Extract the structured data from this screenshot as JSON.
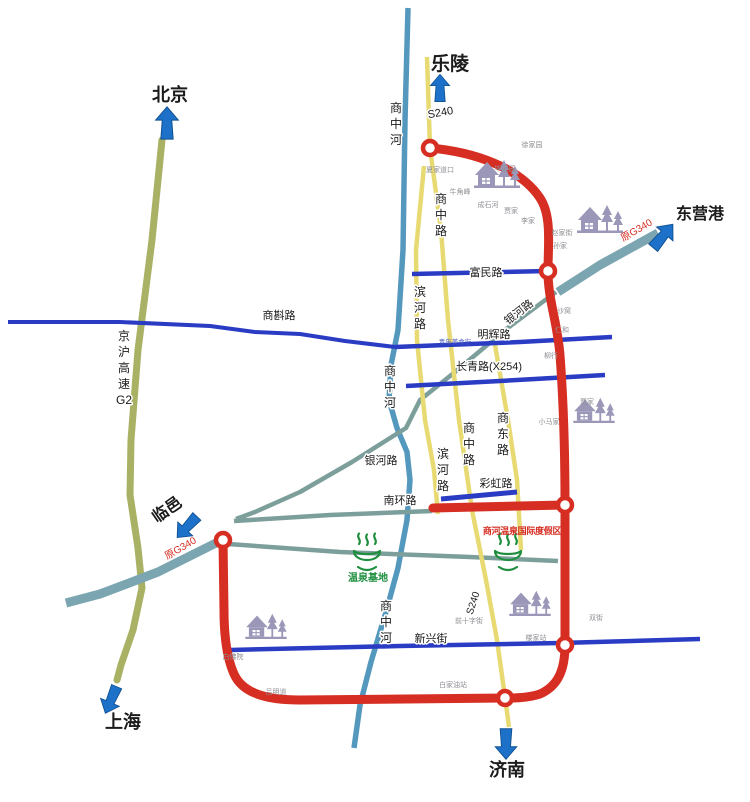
{
  "map": {
    "canvas": {
      "w": 750,
      "h": 802,
      "bg": "#ffffff"
    },
    "palette": {
      "black": "#1b1b1b",
      "gray": "#8f8f95",
      "red": "#d62e22",
      "green": "#1f8f3f",
      "white": "#ffffff",
      "blueSmall": "#4a5ac0",
      "arrow": "#1d71c8",
      "arrowEdge": "#10508f",
      "olive": "#a9b264",
      "river": "#5598bd",
      "corridor": "#7ba5b0",
      "teal": "#7d9f9b",
      "yellow": "#e8da72",
      "blue": "#2a3bc4",
      "icon": "#9a97b8"
    },
    "roads": [
      {
        "id": "jinghu-expressway-g2",
        "color": "olive",
        "w": 7,
        "cap": "round",
        "pts": [
          [
            162,
            140
          ],
          [
            152,
            240
          ],
          [
            138,
            350
          ],
          [
            131,
            440
          ],
          [
            130,
            495
          ],
          [
            138,
            548
          ],
          [
            142,
            588
          ],
          [
            133,
            630
          ],
          [
            121,
            665
          ],
          [
            117,
            680
          ]
        ]
      },
      {
        "id": "old-g340-beizhanhe-northeast",
        "color": "corridor",
        "w": 9,
        "pts": [
          [
            658,
            233
          ],
          [
            600,
            265
          ],
          [
            558,
            292
          ]
        ]
      },
      {
        "id": "old-g340-beizhanhe-southwest",
        "color": "corridor",
        "w": 9,
        "pts": [
          [
            226,
            538
          ],
          [
            158,
            572
          ],
          [
            100,
            594
          ],
          [
            66,
            603
          ]
        ]
      },
      {
        "id": "shangzhong-river",
        "color": "river",
        "w": 5.5,
        "pts": [
          [
            408,
            8
          ],
          [
            405,
            120
          ],
          [
            403,
            250
          ],
          [
            398,
            330
          ],
          [
            391,
            365
          ],
          [
            389,
            400
          ],
          [
            397,
            428
          ],
          [
            407,
            452
          ],
          [
            410,
            480
          ],
          [
            407,
            520
          ],
          [
            398,
            568
          ],
          [
            386,
            612
          ],
          [
            371,
            662
          ],
          [
            360,
            705
          ],
          [
            354,
            748
          ]
        ]
      },
      {
        "id": "yinhe-road",
        "color": "teal",
        "w": 4.5,
        "pts": [
          [
            556,
            292
          ],
          [
            505,
            330
          ],
          [
            455,
            372
          ],
          [
            420,
            400
          ],
          [
            406,
            428
          ],
          [
            352,
            462
          ],
          [
            300,
            492
          ],
          [
            255,
            512
          ],
          [
            236,
            519
          ]
        ]
      },
      {
        "id": "nanhuan-road",
        "color": "teal",
        "w": 4.5,
        "pts": [
          [
            234,
            521
          ],
          [
            330,
            515
          ],
          [
            432,
            511
          ]
        ]
      },
      {
        "id": "old-g340-town-section",
        "color": "teal",
        "w": 4.5,
        "pts": [
          [
            228,
            544
          ],
          [
            340,
            552
          ],
          [
            470,
            557
          ],
          [
            558,
            561
          ]
        ]
      },
      {
        "id": "s240-shangzhong-road",
        "color": "yellow",
        "w": 4.5,
        "pts": [
          [
            427,
            57
          ],
          [
            430,
            148
          ],
          [
            441,
            230
          ],
          [
            448,
            320
          ],
          [
            459,
            420
          ],
          [
            472,
            510
          ],
          [
            486,
            580
          ],
          [
            497,
            640
          ],
          [
            505,
            697
          ],
          [
            509,
            727
          ]
        ]
      },
      {
        "id": "binhe-road",
        "color": "yellow",
        "w": 4.5,
        "pts": [
          [
            424,
            166
          ],
          [
            416,
            250
          ],
          [
            417,
            340
          ],
          [
            425,
            420
          ],
          [
            434,
            470
          ],
          [
            438,
            514
          ]
        ]
      },
      {
        "id": "shangdong-road",
        "color": "yellow",
        "w": 4.5,
        "pts": [
          [
            495,
            345
          ],
          [
            508,
            420
          ],
          [
            517,
            480
          ],
          [
            521,
            550
          ]
        ]
      },
      {
        "id": "fumin-road",
        "color": "blue",
        "w": 4.5,
        "pts": [
          [
            412,
            274
          ],
          [
            548,
            271
          ]
        ]
      },
      {
        "id": "shangzhen-road",
        "color": "blue",
        "w": 4,
        "pts": [
          [
            8,
            322
          ],
          [
            120,
            322
          ],
          [
            210,
            326
          ],
          [
            255,
            332
          ],
          [
            300,
            334
          ],
          [
            345,
            341
          ],
          [
            395,
            347
          ]
        ]
      },
      {
        "id": "minghui-road",
        "color": "blue",
        "w": 4.5,
        "pts": [
          [
            395,
            347
          ],
          [
            520,
            342
          ],
          [
            612,
            337
          ]
        ]
      },
      {
        "id": "changqing-road-x254",
        "color": "blue",
        "w": 4.5,
        "pts": [
          [
            406,
            386
          ],
          [
            500,
            381
          ],
          [
            605,
            375
          ]
        ]
      },
      {
        "id": "caihong-road",
        "color": "blue",
        "w": 5,
        "pts": [
          [
            441,
            499
          ],
          [
            517,
            492
          ]
        ]
      },
      {
        "id": "xinxing-street",
        "color": "blue",
        "w": 4.5,
        "pts": [
          [
            230,
            650
          ],
          [
            400,
            646
          ],
          [
            560,
            643
          ],
          [
            700,
            639
          ]
        ]
      },
      {
        "id": "s240-ring-road",
        "color": "red",
        "w": 9,
        "path": "M 430,148 C 475,152 520,168 540,198 C 552,216 548,245 548,271 C 548,300 557,320 560,355 C 563,395 565,450 565,505 L 565,645 C 565,670 558,686 540,694 C 528,698 515,698 505,698 L 300,700 C 268,700 243,694 234,674 C 226,656 224,630 224,610 L 223,540"
      },
      {
        "id": "resort-access-road",
        "color": "red",
        "w": 9,
        "cap": "round",
        "pts": [
          [
            433,
            508
          ],
          [
            565,
            505
          ]
        ]
      }
    ],
    "junctions": {
      "r": 7,
      "points": [
        [
          430,
          148
        ],
        [
          548,
          271
        ],
        [
          223,
          540
        ],
        [
          565,
          505
        ],
        [
          565,
          645
        ],
        [
          505,
          698
        ]
      ]
    },
    "village_icons": [
      [
        497,
        188,
        1.0
      ],
      [
        600,
        233,
        1.0
      ],
      [
        594,
        423,
        0.9
      ],
      [
        530,
        616,
        0.9
      ],
      [
        266,
        639,
        0.9
      ]
    ],
    "spring_logos": [
      [
        367,
        562
      ],
      [
        508,
        562
      ]
    ],
    "arrows": [
      {
        "id": "beijing",
        "x": 167,
        "y": 123,
        "rot": 0,
        "sc": 0.95
      },
      {
        "id": "leling",
        "x": 440,
        "y": 88,
        "rot": 0,
        "sc": 0.8
      },
      {
        "id": "dongyinggang",
        "x": 663,
        "y": 236,
        "rot": 40,
        "sc": 0.9
      },
      {
        "id": "linyi",
        "x": 187,
        "y": 527,
        "rot": 223,
        "sc": 0.85
      },
      {
        "id": "shanghai",
        "x": 111,
        "y": 700,
        "rot": 203,
        "sc": 0.85
      },
      {
        "id": "jinan",
        "x": 506,
        "y": 744,
        "rot": 180,
        "sc": 0.9
      }
    ],
    "labels": [
      {
        "id": "dest-beijing",
        "t": "北京",
        "x": 170,
        "y": 101,
        "s": 18,
        "c": "black",
        "b": 1
      },
      {
        "id": "dest-leling",
        "t": "乐陵",
        "x": 450,
        "y": 70,
        "s": 19,
        "c": "black",
        "b": 1
      },
      {
        "id": "dest-dongyinggang",
        "t": "东营港",
        "x": 700,
        "y": 219,
        "s": 16,
        "c": "black",
        "b": 1
      },
      {
        "id": "dest-linyi",
        "t": "临邑",
        "x": 170,
        "y": 514,
        "s": 16,
        "c": "black",
        "b": 1,
        "rot": -35
      },
      {
        "id": "dest-shanghai",
        "t": "上海",
        "x": 123,
        "y": 728,
        "s": 18,
        "c": "black",
        "b": 1
      },
      {
        "id": "dest-jinan",
        "t": "济南",
        "x": 507,
        "y": 776,
        "s": 18,
        "c": "black",
        "b": 1
      },
      {
        "id": "label-s240-north",
        "t": "S240",
        "x": 441,
        "y": 116,
        "s": 11,
        "c": "black",
        "halo": 1,
        "rot": -10
      },
      {
        "id": "label-s240-south",
        "t": "S240",
        "x": 476,
        "y": 604,
        "s": 10,
        "c": "black",
        "halo": 1,
        "rot": -72
      },
      {
        "id": "label-shangzhonghe-north",
        "t": "商中河",
        "x": 396,
        "y": 112,
        "s": 12,
        "c": "black",
        "v": 1,
        "halo": 1
      },
      {
        "id": "label-shangzhonghe-middle",
        "t": "商中河",
        "x": 390,
        "y": 375,
        "s": 12,
        "c": "black",
        "v": 1,
        "halo": 1
      },
      {
        "id": "label-shangzhonghe-south",
        "t": "商中河",
        "x": 386,
        "y": 610,
        "s": 12,
        "c": "black",
        "v": 1,
        "halo": 1
      },
      {
        "id": "label-shangzhong-road-north",
        "t": "商中路",
        "x": 441,
        "y": 203,
        "s": 12,
        "c": "black",
        "v": 1,
        "halo": 1
      },
      {
        "id": "label-shangzhong-road-south",
        "t": "商中路",
        "x": 469,
        "y": 432,
        "s": 12,
        "c": "black",
        "v": 1,
        "halo": 1
      },
      {
        "id": "label-binhe-road-north",
        "t": "滨河路",
        "x": 420,
        "y": 296,
        "s": 12,
        "c": "black",
        "v": 1,
        "halo": 1
      },
      {
        "id": "label-binhe-road-south",
        "t": "滨河路",
        "x": 443,
        "y": 458,
        "s": 12,
        "c": "black",
        "v": 1,
        "halo": 1
      },
      {
        "id": "label-shangdong-road",
        "t": "商东路",
        "x": 503,
        "y": 422,
        "s": 12,
        "c": "black",
        "v": 1,
        "halo": 1
      },
      {
        "id": "label-jinghu-g2",
        "t": "京沪高速G2",
        "x": 124,
        "y": 340,
        "s": 12,
        "c": "black",
        "v": 1,
        "halo": 1
      },
      {
        "id": "label-fumin-road",
        "t": "富民路",
        "x": 486,
        "y": 276,
        "s": 11,
        "c": "black",
        "halo": 1
      },
      {
        "id": "label-shangzhen-road",
        "t": "商斟路",
        "x": 279,
        "y": 319,
        "s": 11,
        "c": "black",
        "halo": 1
      },
      {
        "id": "label-minghui-road",
        "t": "明辉路",
        "x": 494,
        "y": 338,
        "s": 11,
        "c": "black",
        "halo": 1
      },
      {
        "id": "label-changqing-road",
        "t": "长青路(X254)",
        "x": 489,
        "y": 370,
        "s": 11,
        "c": "black",
        "halo": 1
      },
      {
        "id": "label-caihong-road",
        "t": "彩虹路",
        "x": 496,
        "y": 487,
        "s": 11,
        "c": "black",
        "halo": 1
      },
      {
        "id": "label-nanhuan-road",
        "t": "南环路",
        "x": 400,
        "y": 504,
        "s": 11,
        "c": "black",
        "halo": 1
      },
      {
        "id": "label-xinxing-street",
        "t": "新兴街",
        "x": 431,
        "y": 642,
        "s": 11,
        "c": "black",
        "halo": 1
      },
      {
        "id": "label-yinhe-road-northeast",
        "t": "银河路",
        "x": 521,
        "y": 315,
        "s": 11,
        "c": "black",
        "halo": 1,
        "rot": -38
      },
      {
        "id": "label-yinhe-road-southwest",
        "t": "银河路",
        "x": 381,
        "y": 464,
        "s": 11,
        "c": "black",
        "halo": 1
      },
      {
        "id": "label-old-g340-northeast",
        "t": "原G340",
        "x": 638,
        "y": 233,
        "s": 10,
        "c": "red",
        "rot": -30
      },
      {
        "id": "label-old-g340-southwest",
        "t": "原G340",
        "x": 182,
        "y": 551,
        "s": 10,
        "c": "red",
        "rot": -30
      },
      {
        "id": "label-beizhanhe-northeast",
        "t": "备战河",
        "x": 610,
        "y": 277,
        "s": 9,
        "c": "white",
        "rot": -35
      },
      {
        "id": "label-beizhanhe-southwest",
        "t": "备战河",
        "x": 186,
        "y": 575,
        "s": 9,
        "c": "white",
        "rot": -30
      },
      {
        "id": "label-wenquan-jidi",
        "t": "温泉基地",
        "x": 368,
        "y": 581,
        "s": 10,
        "c": "green",
        "b": 1
      },
      {
        "id": "label-resort",
        "t": "商河温泉国际度假区",
        "x": 522,
        "y": 534,
        "s": 9,
        "c": "red",
        "b": 1,
        "sp": "-0.3"
      },
      {
        "id": "label-qingnian-food-street",
        "t": "青年美食街",
        "x": 455,
        "y": 344,
        "s": 6.5,
        "c": "blueSmall"
      },
      {
        "id": "village-xujiayuan",
        "t": "徐家园",
        "x": 532,
        "y": 147,
        "s": 7,
        "c": "gray"
      },
      {
        "id": "village-xiajiadaokou",
        "t": "夏家道口",
        "x": 440,
        "y": 172,
        "s": 7,
        "c": "gray"
      },
      {
        "id": "village-bijiayuan",
        "t": "毕家园",
        "x": 505,
        "y": 171,
        "s": 7,
        "c": "gray"
      },
      {
        "id": "village-niujiaofeng",
        "t": "牛角峰",
        "x": 460,
        "y": 194,
        "s": 7,
        "c": "gray"
      },
      {
        "id": "village-chengshihe",
        "t": "成石河",
        "x": 488,
        "y": 207,
        "s": 7,
        "c": "gray"
      },
      {
        "id": "village-jiajia-north",
        "t": "贾家",
        "x": 511,
        "y": 213,
        "s": 7,
        "c": "gray"
      },
      {
        "id": "village-lijia",
        "t": "李家",
        "x": 528,
        "y": 223,
        "s": 7,
        "c": "gray"
      },
      {
        "id": "village-zhaojiajie",
        "t": "赵家街",
        "x": 562,
        "y": 235,
        "s": 7,
        "c": "gray"
      },
      {
        "id": "village-sunjia",
        "t": "孙家",
        "x": 560,
        "y": 248,
        "s": 7,
        "c": "gray"
      },
      {
        "id": "village-shawo",
        "t": "沙窝",
        "x": 564,
        "y": 313,
        "s": 7,
        "c": "gray"
      },
      {
        "id": "village-renhe",
        "t": "仁和",
        "x": 562,
        "y": 332,
        "s": 7,
        "c": "gray"
      },
      {
        "id": "village-liuhang",
        "t": "柳行",
        "x": 551,
        "y": 358,
        "s": 7,
        "c": "gray"
      },
      {
        "id": "village-xiaomajia",
        "t": "小马家",
        "x": 549,
        "y": 424,
        "s": 7,
        "c": "gray"
      },
      {
        "id": "village-jiajia-east",
        "t": "贾家",
        "x": 587,
        "y": 404,
        "s": 7,
        "c": "gray"
      },
      {
        "id": "village-shuangjie",
        "t": "双街",
        "x": 596,
        "y": 620,
        "s": 7,
        "c": "gray"
      },
      {
        "id": "village-loujiazhan",
        "t": "楼家站",
        "x": 536,
        "y": 640,
        "s": 7,
        "c": "gray"
      },
      {
        "id": "village-baifoyuan",
        "t": "白佛院",
        "x": 233,
        "y": 659,
        "s": 7,
        "c": "gray"
      },
      {
        "id": "village-lvmingdao",
        "t": "吕明道",
        "x": 276,
        "y": 694,
        "s": 7,
        "c": "gray"
      },
      {
        "id": "village-baijiayouzhan",
        "t": "白家油站",
        "x": 453,
        "y": 687,
        "s": 7,
        "c": "gray"
      },
      {
        "id": "village-qianshizijie",
        "t": "前十字街",
        "x": 469,
        "y": 623,
        "s": 7,
        "c": "gray"
      }
    ]
  }
}
